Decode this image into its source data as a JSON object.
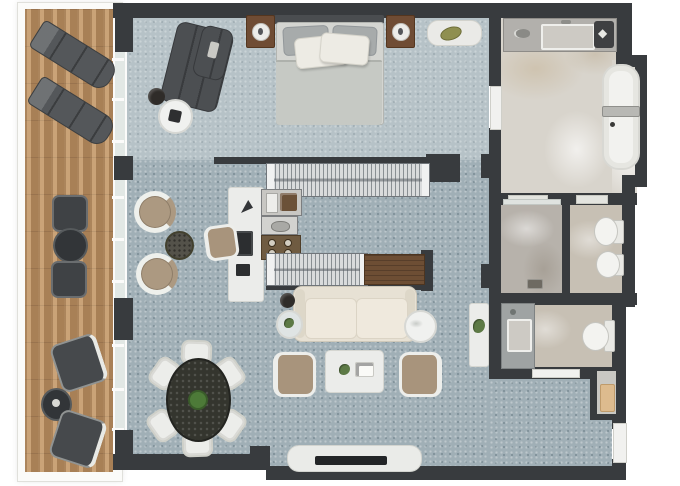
{
  "scene": {
    "type": "architectural-floor-plan",
    "view": "top-down-3d-render",
    "description": "One-bedroom suite floor plan with full-height left terrace, open bedroom/living space, galley wardrobe-kitchenette, bathroom block on the right and entry hall"
  },
  "colors": {
    "wall": "#383b3e",
    "carpet": "#a0afb6",
    "wood": "#bb9165",
    "marble": "#d8d4cc",
    "counterwood": "#6d4e34",
    "white_furniture": "#ebecea",
    "tan_seat": "#a8947c",
    "dark_furniture": "#4c4f52",
    "cream_sofa": "#e7e1d4",
    "plant_green": "#5d7a46"
  },
  "rooms": [
    {
      "id": "terrace",
      "furniture": [
        "sun-lounger",
        "sun-lounger",
        "bistro-chair",
        "bistro-table",
        "bistro-chair",
        "patio-chair",
        "patio-side-table",
        "patio-chair"
      ]
    },
    {
      "id": "bedroom",
      "furniture": [
        "double-bed-with-pillows",
        "nightstand-with-lamp",
        "nightstand-with-lamp",
        "chaise-lounge",
        "round-side-table",
        "decorative-bowl",
        "bench-with-bag"
      ]
    },
    {
      "id": "wardrobe-kitchenette",
      "furniture": [
        "hanging-wardrobe-counter",
        "oven-unit",
        "sink-unit",
        "cooktop-4-burner",
        "counter-with-wood-top",
        "desk-with-laptop",
        "desk-chair"
      ]
    },
    {
      "id": "sitting-nook",
      "furniture": [
        "armchair",
        "side-table",
        "armchair"
      ]
    },
    {
      "id": "living-dining",
      "furniture": [
        "sofa",
        "plant-side-table",
        "table-lamp",
        "marble-side-table",
        "coffee-table",
        "lounge-chair",
        "lounge-chair",
        "tv-console",
        "tv",
        "round-dining-table-with-centerpiece",
        "dining-chair-x6"
      ]
    },
    {
      "id": "bathroom",
      "furniture": [
        "double-vanity-with-sink",
        "accessory-tray",
        "freestanding-bathtub",
        "walk-in-shower-with-drain",
        "toilet",
        "bidet"
      ]
    },
    {
      "id": "powder-room",
      "furniture": [
        "vanity-sink",
        "toilet"
      ]
    },
    {
      "id": "entry-hall",
      "furniture": [
        "console-with-plant",
        "luggage-nook",
        "entrance-door"
      ]
    }
  ],
  "windows": {
    "glazed_wall": "left side, full height with mullions",
    "mullion_count": 9
  },
  "doors": [
    "bedroom-to-bathroom",
    "shower-threshold",
    "wc-threshold",
    "powder-room-door",
    "entrance-door"
  ]
}
